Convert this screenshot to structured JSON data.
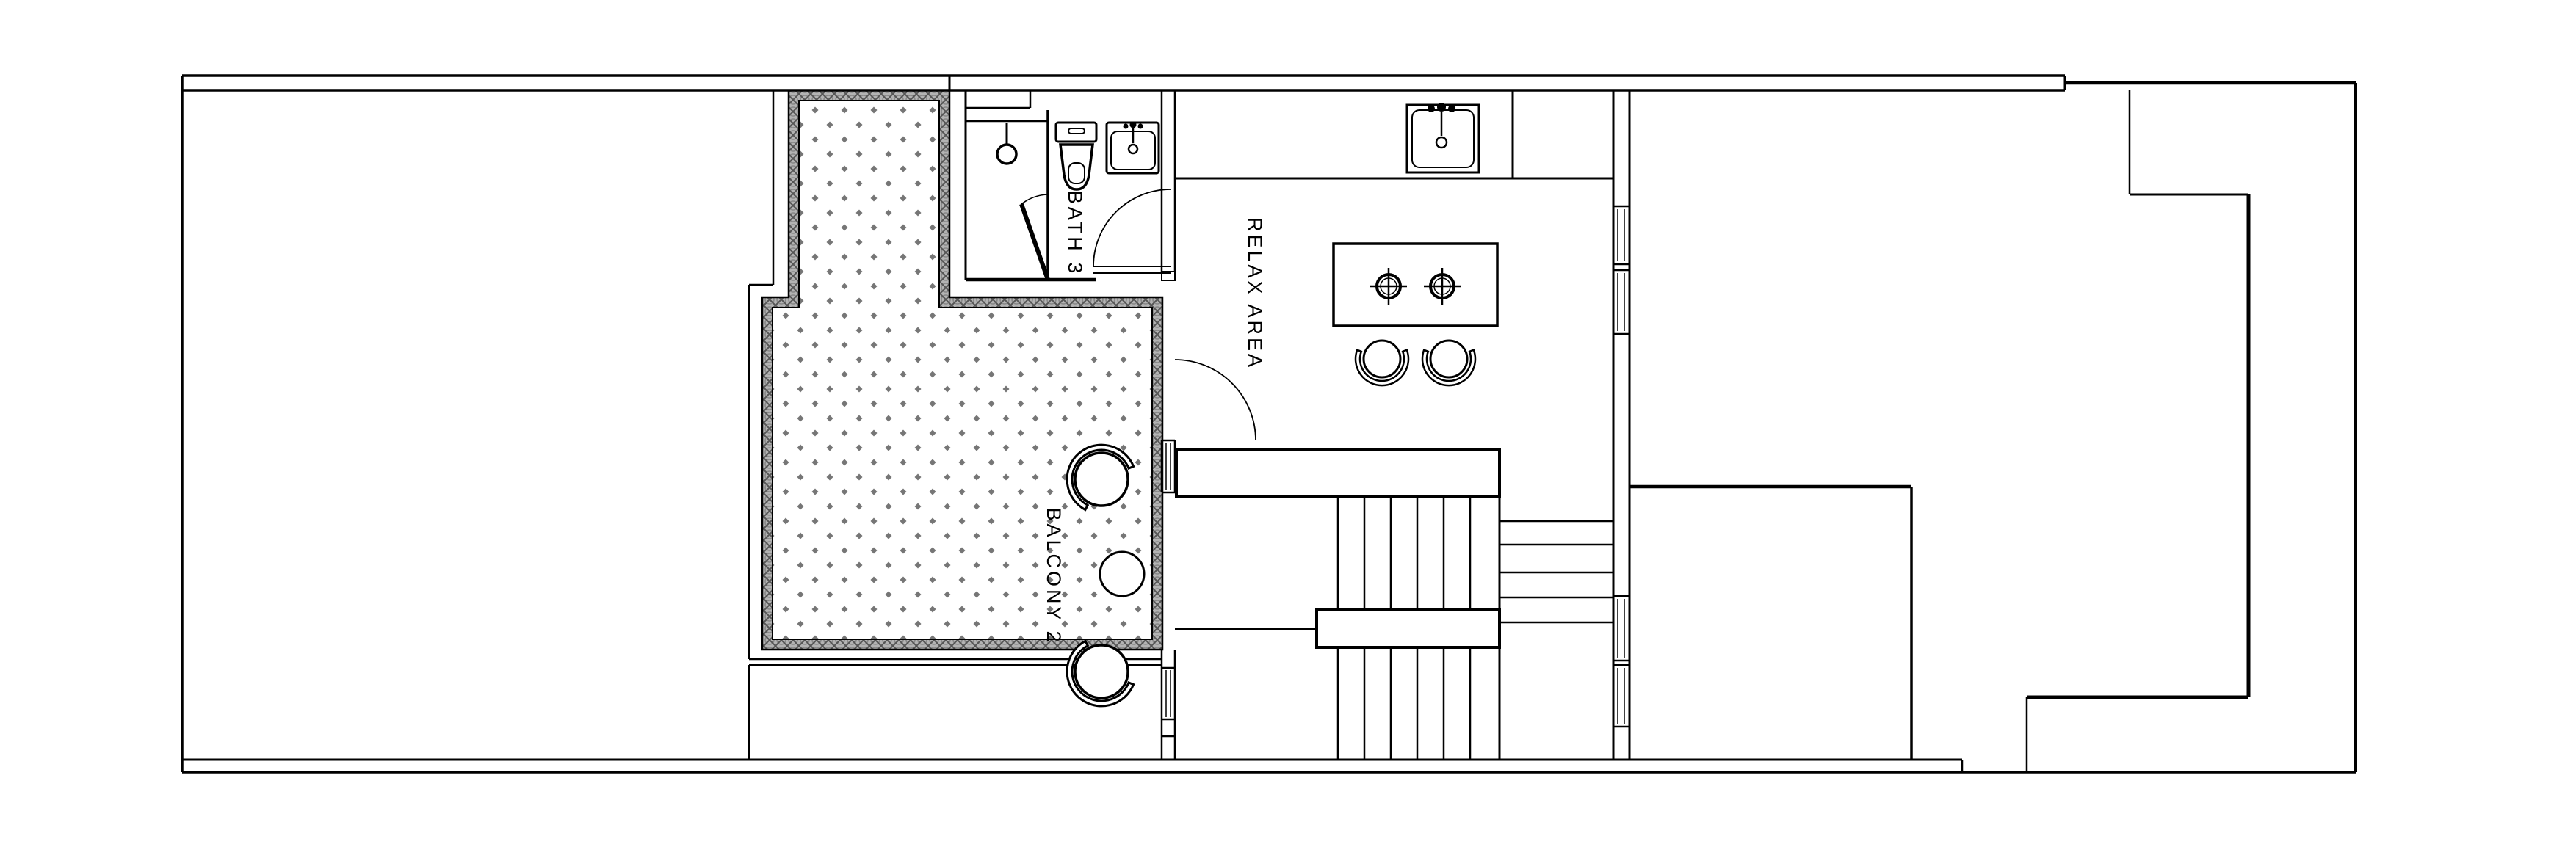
{
  "page": {
    "background": "#ffffff",
    "kind": "architectural-floor-plan"
  },
  "drawing": {
    "line_color": "#000000",
    "hatch_dot_color": "#767676",
    "hatch_band_color": "#acacac",
    "rooms": [
      {
        "id": "bath-3",
        "label": "BATH 3"
      },
      {
        "id": "relax-area",
        "label": "RELAX AREA"
      },
      {
        "id": "balcony-2",
        "label": "BALCONY 2"
      }
    ],
    "fixtures": [
      "shower-head",
      "shower-door",
      "toilet",
      "bathroom-sink",
      "kitchen-counter",
      "kitchen-sink",
      "cooktop-island",
      "dining-chair-left",
      "dining-chair-right",
      "balcony-chair-upper",
      "balcony-chair-lower",
      "balcony-side-table",
      "staircase-upper-landing",
      "staircase-mid-landing",
      "stair-treads-vertical",
      "stair-treads-horizontal",
      "window-wall",
      "balcony-deck-hatch",
      "door-swings"
    ]
  }
}
